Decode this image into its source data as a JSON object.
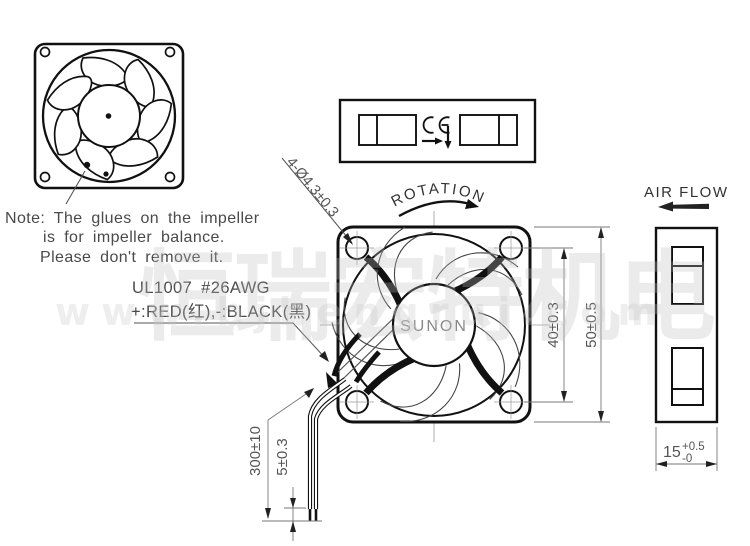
{
  "note": {
    "line1": "Note: The glues on the impeller",
    "line2": "is for impeller balance.",
    "line3": "Please don't remove it."
  },
  "wire_spec": {
    "line1": "UL1007  #26AWG",
    "line2": "+:RED(红),-:BLACK(黑)"
  },
  "labels": {
    "rotation": "ROTATION",
    "air_flow": "AIR FLOW",
    "brand": "SUNON"
  },
  "dimensions": {
    "mounting_holes": "4-Ø4.3±0.3",
    "hole_pitch": "40±0.3",
    "frame_size": "50±0.5",
    "lead_length": "300±10",
    "strip_length": "5±0.3",
    "thickness_value": "15",
    "thickness_upper": "+0.5",
    "thickness_lower": "-0"
  },
  "watermark": {
    "cn": "恒瑞宏特机电",
    "url": "www.bjhengrui.com"
  },
  "colors": {
    "line": "#111111",
    "thin_line": "#555555",
    "centerline": "#9a9a9a",
    "watermark": "#e8e8e8"
  }
}
